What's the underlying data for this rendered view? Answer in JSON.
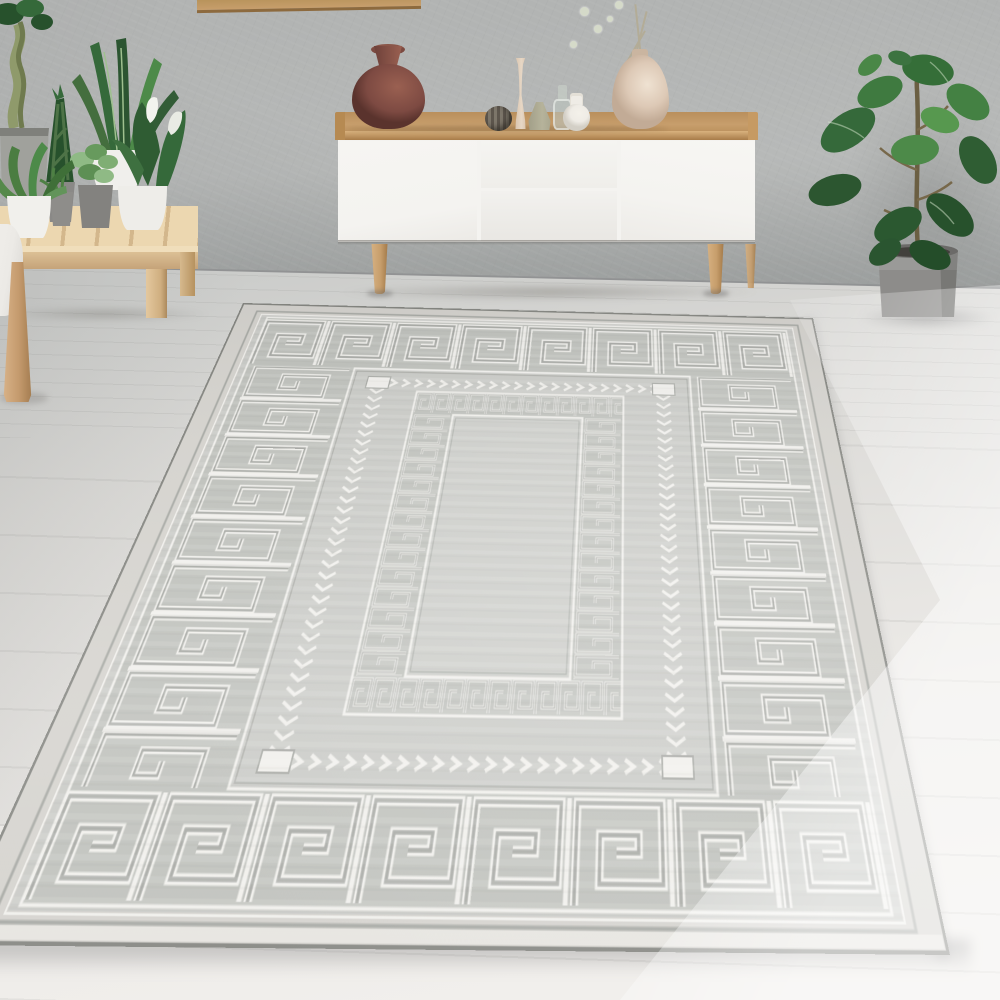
{
  "scene": {
    "title": "Bright living room with a grey Greek-key bordered rug",
    "objects": {
      "wall": "grey textured plaster wall",
      "pictureFrame": "wooden picture frame, partially visible at top",
      "floor": "pale wooden plank floor",
      "sideboard": "white sideboard with oak tray top and tapered legs",
      "sideboardLeftDoor": "left white door",
      "sideboardTopDrawer": "upper middle drawer",
      "sideboardBottomDrawer": "lower middle drawer",
      "sideboardRightDoor": "right white door",
      "clayVase": "round brown clay vase",
      "ribbedVase": "small ribbed dark vase",
      "candlestickVase": "tall slim cream candlestick vase",
      "coneVase": "sage green cone vase",
      "glassBottle": "small clear glass bottle",
      "bottleVase": "small white bottle vase",
      "teardropVase": "large beige teardrop vase with dried stems",
      "driedStems": "dried flower stems with pale pompom blooms",
      "bench": "low slatted wooden plant bench",
      "fern": "fern in white pot",
      "snakePlant": "tall sansevieria snake plant",
      "fittonia": "small leafy plant in grey pot",
      "callaLily": "calla lily with white blooms in white pot",
      "braidedSansevieria": "braided sansevieria sculpture",
      "braidedTree": "braided-trunk plant in concrete pot",
      "sofa": "edge of light grey sofa with wooden leg",
      "rug": "grey rug with Greek key meander border, chevron inner border and central panel",
      "greekKeyBorder": "large Greek key meander border band",
      "chevronBorder": "white chevron arrow border",
      "innerPanel": "inner rectangle with small Greek key border",
      "fiddleLeafFig": "fiddle leaf fig plant",
      "figPot": "grey cylindrical plant pot"
    }
  },
  "palette": {
    "wall": "#b2b4b3",
    "wallLight": "#b7b9b8",
    "wallShade": "#a5a8a7",
    "baseboard": "#8f9192",
    "floorFar": "#cbccca",
    "floorMid": "#dbdad7",
    "floorNear": "#eceae7",
    "rugMargin": "#d4d2cd",
    "rugField": "#c8c9c5",
    "rugBand": "#bec0bb",
    "rugInnerField": "#cbccc8",
    "rugWhite": "#f0efeb",
    "rugGray": "#a6a8a3",
    "rugEdge": "#83847f",
    "wood": "#c79e6c",
    "woodLight": "#ecd7b0",
    "cabinet": "#f4f3f0",
    "clay": "#7d4a42",
    "clayLight": "#9a6051",
    "cream": "#e7d7c5",
    "beige": "#ddc9b6",
    "sage": "#b6b39b",
    "bottleWhite": "#efece6",
    "potGray": "#8d8c8a",
    "soil": "#42403c",
    "concrete": "#a0a19c",
    "leafDark": "#27512c",
    "leaf": "#35693a",
    "leafLight": "#4d8a49",
    "leafPale": "#57984f",
    "stem": "#6b5f43",
    "sofa": "#eceae6",
    "sofaShade": "#d8d6d2",
    "pompom": "#d5dac9"
  }
}
